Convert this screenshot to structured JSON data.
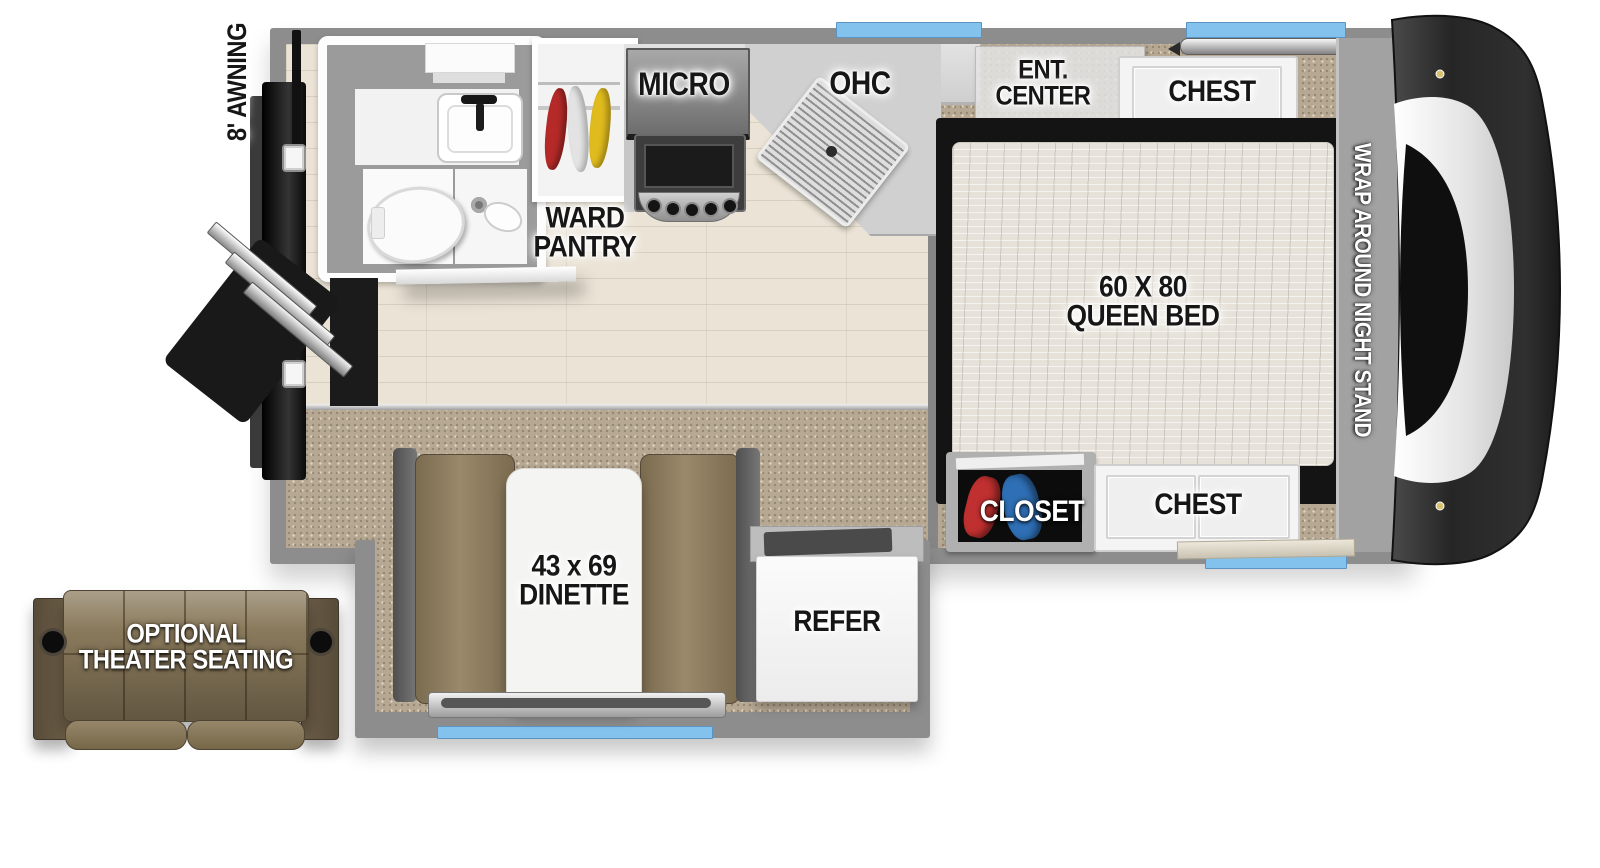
{
  "labels": {
    "awning": "8' AWNING",
    "ward_pantry": "WARD\nPANTRY",
    "micro": "MICRO",
    "ohc": "OHC",
    "ent_center": "ENT.\nCENTER",
    "chest_rear": "CHEST",
    "queen_bed": "60 X 80\nQUEEN BED",
    "night_stand": "WRAP AROUND NIGHT STAND",
    "closet": "CLOSET",
    "chest_front": "CHEST",
    "dinette": "43 x 69\nDINETTE",
    "refer": "REFER",
    "theater_seating": "OPTIONAL\nTHEATER SEATING"
  },
  "colors": {
    "window_blue": "#84c2ee",
    "wall_gray": "#8d8d8d",
    "carpet_brown": "#b6a892",
    "wood_floor": "#ebe4d6",
    "bench_brown": "#8d7b5c",
    "sofa_brown": "#84755a",
    "mattress_beige": "#e7e2d9",
    "tv_navy": "#16365f",
    "label_black": "#161616",
    "label_white": "#ffffff"
  }
}
